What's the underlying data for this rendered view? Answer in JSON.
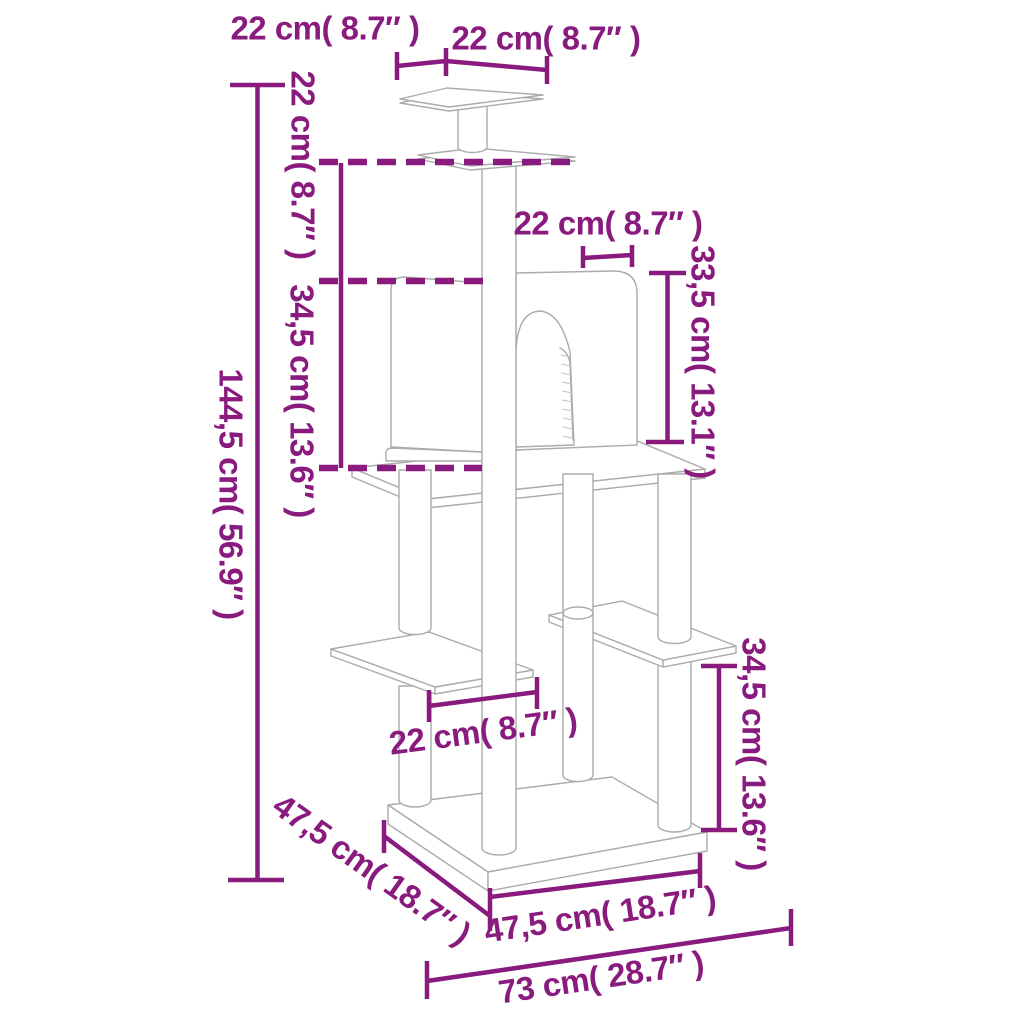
{
  "page": {
    "title": "Cat tree dimension diagram",
    "background": "#FFFFFF"
  },
  "diagram": {
    "type": "product-dimension-diagram",
    "subject": "cat tree with scratching posts, condo, platforms and base board",
    "dimension_color": "#8A1B7E",
    "artwork_line_color": "#ABABAB"
  },
  "labels": {
    "top_platform_depth": {
      "text": "22 cm( 8.7″ )",
      "cm": "22",
      "in": "8.7"
    },
    "top_platform_width": {
      "text": "22 cm( 8.7″ )",
      "cm": "22",
      "in": "8.7"
    },
    "top_tier_height": {
      "text": "22 cm( 8.7″ )",
      "cm": "22",
      "in": "8.7"
    },
    "condo_depth": {
      "text": "22 cm( 8.7″ )",
      "cm": "22",
      "in": "8.7"
    },
    "condo_height": {
      "text": "33,5 cm( 13.1″ )",
      "cm": "33,5",
      "in": "13.1"
    },
    "middle_tier_height": {
      "text": "34,5 cm( 13.6″ )",
      "cm": "34,5",
      "in": "13.6"
    },
    "overall_height": {
      "text": "144,5 cm( 56.9″ )",
      "cm": "144,5",
      "in": "56.9"
    },
    "perch_width": {
      "text": "22 cm( 8.7″ )",
      "cm": "22",
      "in": "8.7"
    },
    "lower_tier_height": {
      "text": "34,5 cm( 13.6″ )",
      "cm": "34,5",
      "in": "13.6"
    },
    "base_depth": {
      "text": "47,5 cm( 18.7″ )",
      "cm": "47,5",
      "in": "18.7"
    },
    "base_width": {
      "text": "47,5 cm( 18.7″ )",
      "cm": "47,5",
      "in": "18.7"
    },
    "overall_width": {
      "text": "73 cm( 28.7″ )",
      "cm": "73",
      "in": "28.7"
    }
  }
}
